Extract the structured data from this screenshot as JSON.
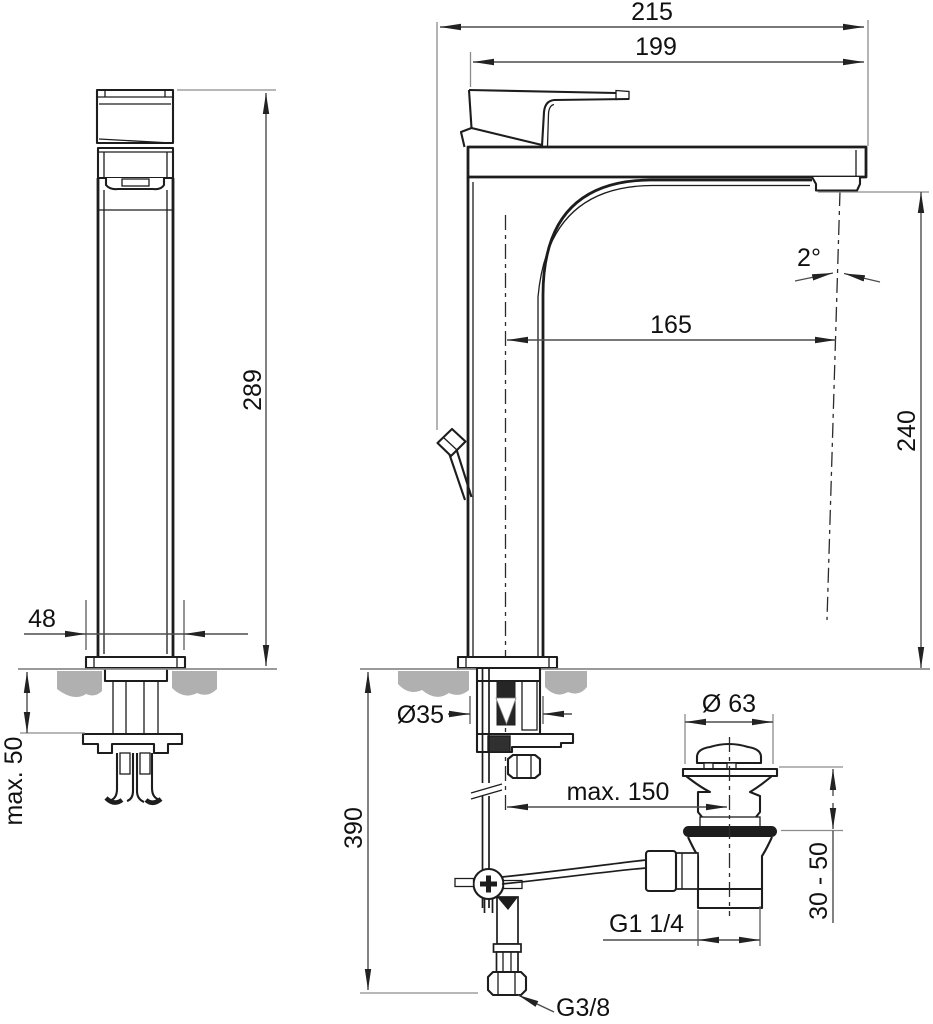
{
  "drawing_type": "faucet-installation-dimension-drawing",
  "labels": {
    "total_depth": "215",
    "body_depth": "199",
    "total_height": "289",
    "base_width": "48",
    "max_deck_thickness": "max. 50",
    "spout_angle": "2°",
    "spout_reach": "165",
    "outlet_height": "240",
    "hole_diameter": "Ø35",
    "below_deck_height": "390",
    "max_rod_reach": "max. 150",
    "waste_flange_diameter": "Ø 63",
    "basin_thickness_range": "30 - 50",
    "waste_thread": "G1 1/4",
    "supply_thread": "G3/8"
  },
  "colors": {
    "line": "#1d1d1d",
    "dimension": "#4d4d4d",
    "extension": "#8c8c8c",
    "counter_fill": "#b0b0b0",
    "background": "#ffffff"
  }
}
